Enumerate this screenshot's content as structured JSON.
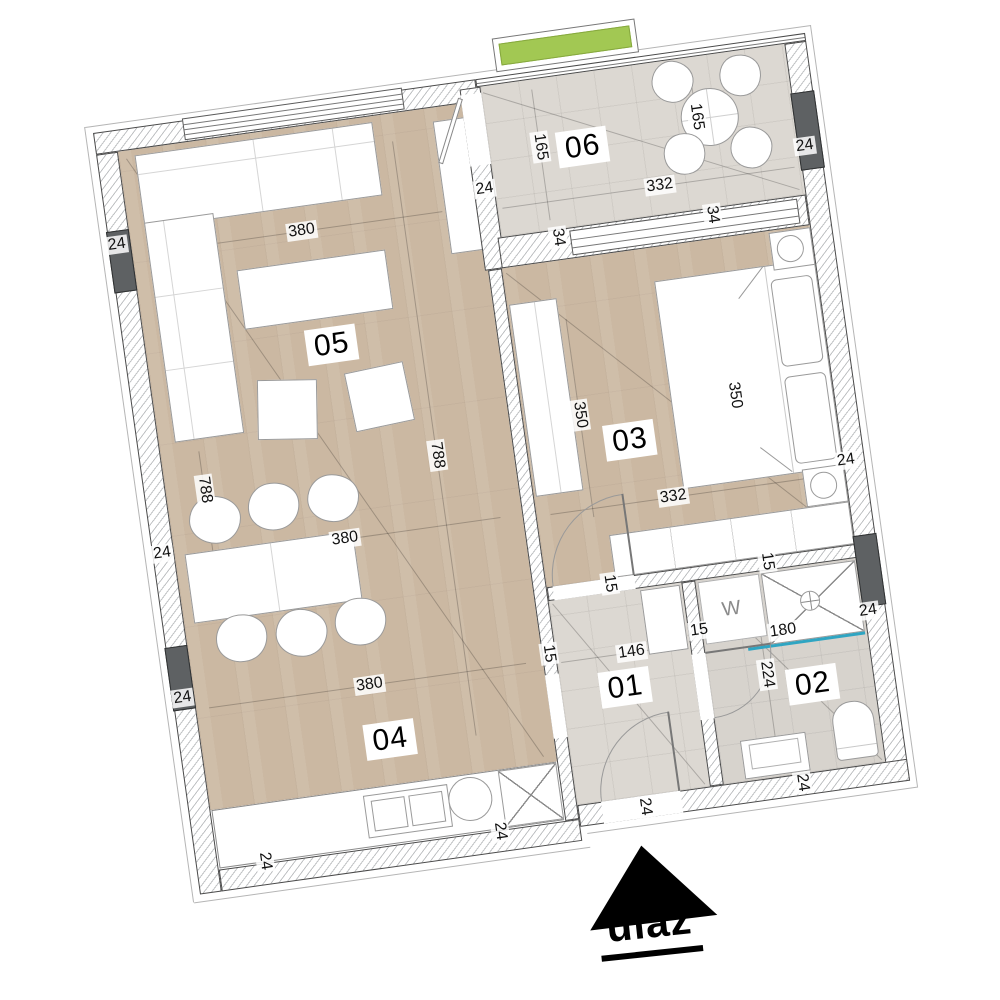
{
  "entrance": {
    "label": "ulaz"
  },
  "room_labels": [
    {
      "text": "05",
      "x": 207,
      "y": 243
    },
    {
      "text": "06",
      "x": 483,
      "y": 82
    },
    {
      "text": "03",
      "x": 489,
      "y": 379
    },
    {
      "text": "04",
      "x": 210,
      "y": 642
    },
    {
      "text": "01",
      "x": 450,
      "y": 623
    },
    {
      "text": "02",
      "x": 636,
      "y": 646
    }
  ],
  "dim_labels": [
    {
      "text": "380",
      "x": 193,
      "y": 126,
      "rot": 0
    },
    {
      "text": "24",
      "x": 8,
      "y": 114,
      "rot": 0
    },
    {
      "text": "24",
      "x": 380,
      "y": 110,
      "rot": 0
    },
    {
      "text": "165",
      "x": 441,
      "y": 76,
      "rot": 90
    },
    {
      "text": "165",
      "x": 600,
      "y": 68,
      "rot": 90
    },
    {
      "text": "332",
      "x": 554,
      "y": 131,
      "rot": 0
    },
    {
      "text": "24",
      "x": 703,
      "y": 112,
      "rot": 0
    },
    {
      "text": "34",
      "x": 446,
      "y": 168,
      "rot": 90
    },
    {
      "text": "34",
      "x": 602,
      "y": 167,
      "rot": 90
    },
    {
      "text": "350",
      "x": 443,
      "y": 347,
      "rot": 90
    },
    {
      "text": "350",
      "x": 599,
      "y": 349,
      "rot": 90
    },
    {
      "text": "788",
      "x": 296,
      "y": 367,
      "rot": 90
    },
    {
      "text": "788",
      "x": 61,
      "y": 369,
      "rot": 90
    },
    {
      "text": "24",
      "x": 700,
      "y": 429,
      "rot": 0
    },
    {
      "text": "332",
      "x": 524,
      "y": 441,
      "rot": 0
    },
    {
      "text": "380",
      "x": 193,
      "y": 437,
      "rot": 0
    },
    {
      "text": "24",
      "x": 10,
      "y": 426,
      "rot": 0
    },
    {
      "text": "15",
      "x": 449,
      "y": 518,
      "rot": 90
    },
    {
      "text": "15",
      "x": 608,
      "y": 518,
      "rot": 90
    },
    {
      "text": "180",
      "x": 614,
      "y": 589,
      "rot": 0
    },
    {
      "text": "24",
      "x": 701,
      "y": 581,
      "rot": 0
    },
    {
      "text": "15",
      "x": 379,
      "y": 579,
      "rot": 90
    },
    {
      "text": "146",
      "x": 461,
      "y": 589,
      "rot": 0
    },
    {
      "text": "15",
      "x": 531,
      "y": 577,
      "rot": 0
    },
    {
      "text": "224",
      "x": 592,
      "y": 630,
      "rot": 90
    },
    {
      "text": "380",
      "x": 197,
      "y": 585,
      "rot": 0
    },
    {
      "text": "24",
      "x": 10,
      "y": 572,
      "rot": 0
    },
    {
      "text": "24",
      "x": 69,
      "y": 745,
      "rot": 90
    },
    {
      "text": "24",
      "x": 306,
      "y": 748,
      "rot": 90
    },
    {
      "text": "24",
      "x": 453,
      "y": 744,
      "rot": 90
    },
    {
      "text": "24",
      "x": 612,
      "y": 742,
      "rot": 90
    }
  ],
  "fixture_labels": [
    {
      "text": "W",
      "x": 566,
      "y": 560
    }
  ],
  "colors": {
    "wood_floor": "#cbb8a2",
    "tile_floor": "#dcd8d2",
    "bath_tile": "#d7d3cd",
    "wall_outline": "#4a4a4a",
    "column": "#5e6163",
    "planter_green": "#a2c853",
    "shower_glass_blue": "#2fa5c2",
    "furniture_outline": "#9a9a9a",
    "arrow_black": "#000000"
  }
}
